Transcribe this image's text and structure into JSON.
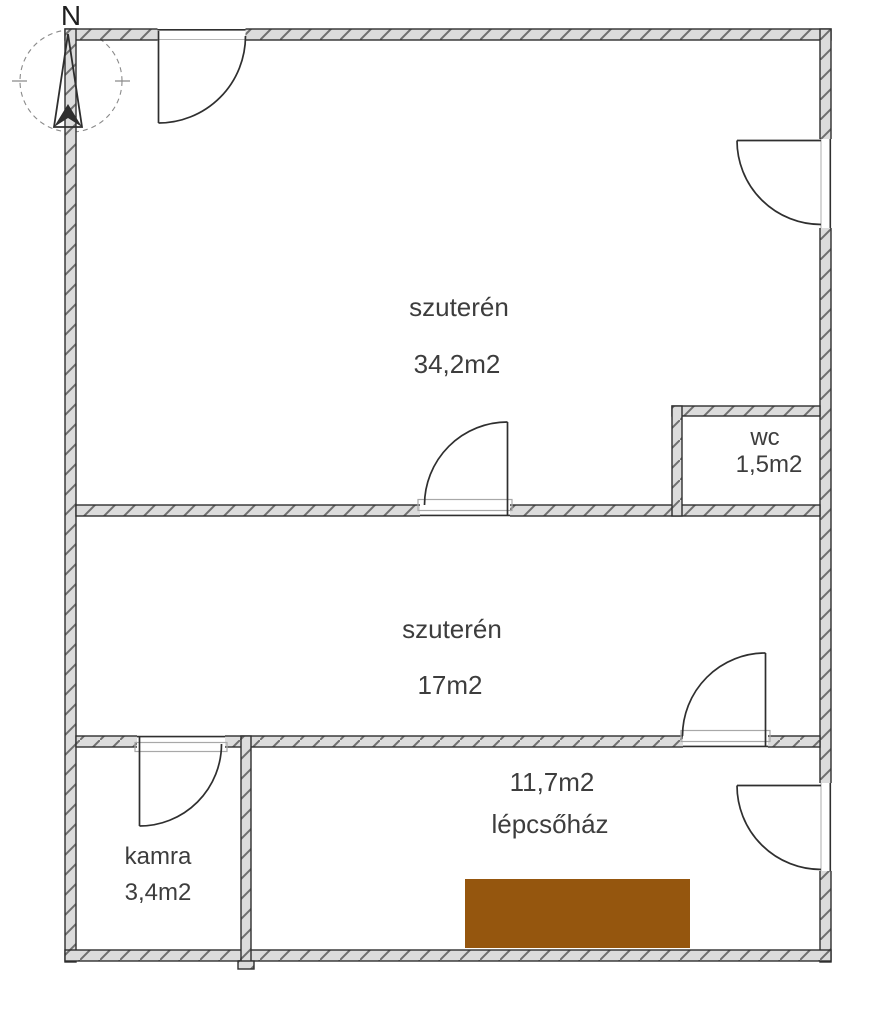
{
  "compass": {
    "north_label": "N"
  },
  "rooms": {
    "szuteren_upper": {
      "name": "szuterén",
      "area": "34,2m2"
    },
    "wc": {
      "name": "wc",
      "area": "1,5m2"
    },
    "szuteren_lower": {
      "name": "szuterén",
      "area": "17m2"
    },
    "lepcsohaz": {
      "name": "lépcsőház",
      "area": "11,7m2"
    },
    "kamra": {
      "name": "kamra",
      "area": "3,4m2"
    }
  },
  "colors": {
    "stairs_fill": "#95560e",
    "wall_fill": "#dcdcdc",
    "wall_hatch": "#6f6f6f",
    "line": "#2f2f2f",
    "text": "#3d3d3d",
    "background": "#ffffff"
  }
}
